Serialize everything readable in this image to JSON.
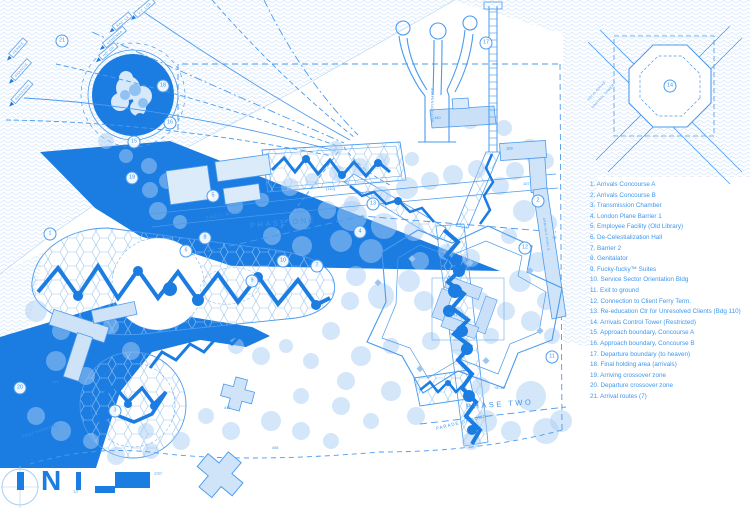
{
  "colors": {
    "primary": "#1b7ce2",
    "line": "#4a9bee",
    "text": "#3f96ed",
    "tree": "#a9cdf3"
  },
  "north_label": "N",
  "scale": {
    "min": "10'",
    "max": "200'"
  },
  "legend": {
    "items": [
      "1. Arrivals Concourse A",
      "2. Arrivals Concourse B",
      "3. Transmission Chamber",
      "4. London Plane Barrier 1",
      "5. Employee Facility (Old Library)",
      "6. De-Celestialization Hall",
      "7. Barrier 2",
      "8. Genitalator",
      "9. Fucky-fucky™ Suites",
      "10. Service Sector Orientation Bldg",
      "11. Exit to ground",
      "12. Connection to Client Ferry Term.",
      "13. Re-education Ctr for Unresolved Clients (Bdg 110)",
      "14. Arrivals Control Tower (Restricted)",
      "15. Approach boundary, Concourse A",
      "16. Approach boundary, Concourse B",
      "17. Departure boundary (to heaven)",
      "18. Final holding area (arrivals)",
      "19. Arriving crossover zone",
      "20. Departure crossover zone",
      "21. Arrival routes (7)"
    ]
  },
  "map": {
    "labels": [
      {
        "t": "ANZIO ROAD",
        "x": 206,
        "y": 215,
        "r": -9,
        "s": 4.2,
        "ls": 1
      },
      {
        "t": "PHASE ONE",
        "x": 250,
        "y": 221,
        "r": -5,
        "s": 7.5,
        "ls": 2.5
      },
      {
        "t": "PHASE TWO",
        "x": 466,
        "y": 402,
        "r": -4,
        "s": 7.5,
        "ls": 2.5
      },
      {
        "t": "PARADE GROUND",
        "x": 436,
        "y": 426,
        "r": -14,
        "s": 4.5,
        "ls": 1
      },
      {
        "t": "POST HOSPITAL",
        "x": 22,
        "y": 434,
        "r": -18,
        "s": 4,
        "ls": 0.5
      },
      {
        "t": "FORT JAY",
        "x": 446,
        "y": 310,
        "r": 12,
        "s": 4,
        "ls": 0.5
      },
      {
        "t": "(110)",
        "x": 326,
        "y": 186,
        "r": 0,
        "s": 4,
        "ls": 0
      },
      {
        "t": "140",
        "x": 434,
        "y": 115,
        "r": 0,
        "s": 4,
        "ls": 0
      },
      {
        "t": "109",
        "x": 506,
        "y": 146,
        "r": -3,
        "s": 4,
        "ls": 0
      },
      {
        "t": "107",
        "x": 523,
        "y": 181,
        "r": 0,
        "s": 4,
        "ls": 0
      },
      {
        "t": "410",
        "x": 224,
        "y": 406,
        "r": 0,
        "s": 3.8,
        "ls": 0
      },
      {
        "t": "408",
        "x": 272,
        "y": 446,
        "r": 0,
        "s": 3.8,
        "ls": 0
      },
      {
        "t": "415",
        "x": 52,
        "y": 380,
        "r": 0,
        "s": 3.8,
        "ls": 0
      },
      {
        "t": "+5'",
        "x": 552,
        "y": 236,
        "r": 0,
        "s": 3.8,
        "ls": 0
      },
      {
        "t": "+5'-10\"",
        "x": 494,
        "y": 386,
        "r": 0,
        "s": 3.8,
        "ls": 0
      },
      {
        "t": "SUSPENSION LINE",
        "x": 432,
        "y": 86,
        "r": 90,
        "s": 3.2,
        "ls": 0.4
      },
      {
        "t": "SOLID ROCKS",
        "x": 588,
        "y": 98,
        "r": -47,
        "s": 3.2,
        "ls": 0.3
      },
      {
        "t": "CONTROL TOWER",
        "x": 592,
        "y": 106,
        "r": -47,
        "s": 3.2,
        "ls": 0.3
      },
      {
        "t": "ARRIVALS CONC B",
        "x": 544,
        "y": 216,
        "r": 82,
        "s": 3,
        "ls": 0.4
      }
    ],
    "route_labels": [
      {
        "t": "FERRIS",
        "x": 16,
        "y": 50,
        "r": -48
      },
      {
        "t": "FRANCIS",
        "x": 19,
        "y": 72,
        "r": -48
      },
      {
        "t": "RANGOON",
        "x": 20,
        "y": 94,
        "r": -48
      },
      {
        "t": "HO' OR",
        "x": 106,
        "y": 53,
        "r": -40
      },
      {
        "t": "GEHENNA",
        "x": 112,
        "y": 39,
        "r": -40
      },
      {
        "t": "RAZ' LA",
        "x": 120,
        "y": 23,
        "r": -40
      },
      {
        "t": "V.T. LOR",
        "x": 142,
        "y": 10,
        "r": -40
      }
    ],
    "markers": [
      {
        "n": "1",
        "x": 50,
        "y": 234
      },
      {
        "n": "2",
        "x": 538,
        "y": 201
      },
      {
        "n": "3",
        "x": 115,
        "y": 411
      },
      {
        "n": "4",
        "x": 360,
        "y": 232
      },
      {
        "n": "5",
        "x": 213,
        "y": 196
      },
      {
        "n": "6",
        "x": 186,
        "y": 251
      },
      {
        "n": "7",
        "x": 317,
        "y": 266
      },
      {
        "n": "8",
        "x": 205,
        "y": 238
      },
      {
        "n": "9",
        "x": 252,
        "y": 281
      },
      {
        "n": "10",
        "x": 283,
        "y": 261
      },
      {
        "n": "11",
        "x": 552,
        "y": 357
      },
      {
        "n": "12",
        "x": 525,
        "y": 248
      },
      {
        "n": "13",
        "x": 373,
        "y": 204
      },
      {
        "n": "14",
        "x": 670,
        "y": 86
      },
      {
        "n": "15",
        "x": 134,
        "y": 142
      },
      {
        "n": "16",
        "x": 170,
        "y": 123
      },
      {
        "n": "17",
        "x": 486,
        "y": 43
      },
      {
        "n": "18",
        "x": 163,
        "y": 86
      },
      {
        "n": "19",
        "x": 132,
        "y": 178
      },
      {
        "n": "20",
        "x": 20,
        "y": 388
      },
      {
        "n": "21",
        "x": 62,
        "y": 41
      }
    ],
    "trees": [
      [
        150,
        190,
        8
      ],
      [
        158,
        211,
        9
      ],
      [
        180,
        222,
        7
      ],
      [
        235,
        206,
        8
      ],
      [
        262,
        200,
        7
      ],
      [
        290,
        187,
        9
      ],
      [
        312,
        180,
        7
      ],
      [
        337,
        173,
        8
      ],
      [
        360,
        167,
        9
      ],
      [
        383,
        160,
        7
      ],
      [
        300,
        219,
        11
      ],
      [
        327,
        210,
        9
      ],
      [
        352,
        204,
        8
      ],
      [
        381,
        196,
        10
      ],
      [
        407,
        188,
        11
      ],
      [
        430,
        181,
        9
      ],
      [
        453,
        175,
        10
      ],
      [
        477,
        169,
        9
      ],
      [
        412,
        159,
        7
      ],
      [
        336,
        148,
        7
      ],
      [
        470,
        120,
        9
      ],
      [
        504,
        128,
        8
      ],
      [
        530,
        150,
        11
      ],
      [
        515,
        171,
        9
      ],
      [
        546,
        161,
        8
      ],
      [
        500,
        186,
        9
      ],
      [
        524,
        211,
        11
      ],
      [
        548,
        223,
        9
      ],
      [
        509,
        236,
        8
      ],
      [
        538,
        262,
        10
      ],
      [
        520,
        281,
        11
      ],
      [
        546,
        301,
        9
      ],
      [
        531,
        321,
        10
      ],
      [
        552,
        336,
        8
      ],
      [
        420,
        261,
        9
      ],
      [
        446,
        252,
        8
      ],
      [
        471,
        258,
        9
      ],
      [
        424,
        301,
        10
      ],
      [
        455,
        316,
        10
      ],
      [
        481,
        301,
        9
      ],
      [
        431,
        341,
        9
      ],
      [
        461,
        346,
        10
      ],
      [
        491,
        336,
        8
      ],
      [
        506,
        311,
        9
      ],
      [
        352,
        216,
        15
      ],
      [
        384,
        226,
        13
      ],
      [
        341,
        241,
        11
      ],
      [
        414,
        231,
        10
      ],
      [
        371,
        251,
        12
      ],
      [
        302,
        246,
        10
      ],
      [
        272,
        236,
        9
      ],
      [
        409,
        281,
        11
      ],
      [
        381,
        296,
        13
      ],
      [
        356,
        276,
        10
      ],
      [
        350,
        301,
        9
      ],
      [
        331,
        331,
        9
      ],
      [
        361,
        356,
        10
      ],
      [
        391,
        346,
        8
      ],
      [
        346,
        381,
        9
      ],
      [
        311,
        361,
        8
      ],
      [
        286,
        346,
        7
      ],
      [
        261,
        356,
        9
      ],
      [
        236,
        346,
        8
      ],
      [
        391,
        391,
        10
      ],
      [
        416,
        416,
        9
      ],
      [
        371,
        421,
        8
      ],
      [
        341,
        406,
        9
      ],
      [
        301,
        396,
        8
      ],
      [
        271,
        421,
        10
      ],
      [
        301,
        431,
        9
      ],
      [
        331,
        441,
        8
      ],
      [
        231,
        431,
        9
      ],
      [
        206,
        416,
        8
      ],
      [
        181,
        441,
        9
      ],
      [
        151,
        451,
        8
      ],
      [
        36,
        311,
        11
      ],
      [
        61,
        331,
        9
      ],
      [
        111,
        326,
        8
      ],
      [
        131,
        351,
        9
      ],
      [
        56,
        361,
        10
      ],
      [
        86,
        376,
        9
      ],
      [
        36,
        416,
        9
      ],
      [
        61,
        431,
        10
      ],
      [
        91,
        441,
        8
      ],
      [
        116,
        456,
        9
      ],
      [
        146,
        431,
        8
      ],
      [
        486,
        421,
        11
      ],
      [
        511,
        431,
        10
      ],
      [
        471,
        441,
        9
      ],
      [
        546,
        431,
        13
      ],
      [
        481,
        386,
        9
      ],
      [
        531,
        396,
        15
      ],
      [
        561,
        421,
        11
      ],
      [
        106,
        141,
        8
      ],
      [
        126,
        156,
        7
      ],
      [
        149,
        166,
        8
      ],
      [
        167,
        181,
        8
      ]
    ],
    "blobs": [
      [
        78,
        296,
        5
      ],
      [
        138,
        271,
        5
      ],
      [
        198,
        300,
        6
      ],
      [
        258,
        277,
        5
      ],
      [
        316,
        305,
        5
      ],
      [
        170,
        289,
        7
      ],
      [
        306,
        159,
        4
      ],
      [
        342,
        175,
        4
      ],
      [
        378,
        163,
        4
      ],
      [
        459,
        271,
        6
      ],
      [
        449,
        311,
        6
      ],
      [
        467,
        349,
        6
      ],
      [
        455,
        291,
        7
      ],
      [
        462,
        331,
        6
      ],
      [
        469,
        396,
        6
      ],
      [
        128,
        404,
        4
      ],
      [
        154,
        406,
        4
      ],
      [
        448,
        383,
        3
      ],
      [
        398,
        201,
        4
      ],
      [
        100,
        418,
        4
      ],
      [
        140,
        118,
        5
      ],
      [
        472,
        430,
        5
      ]
    ]
  }
}
